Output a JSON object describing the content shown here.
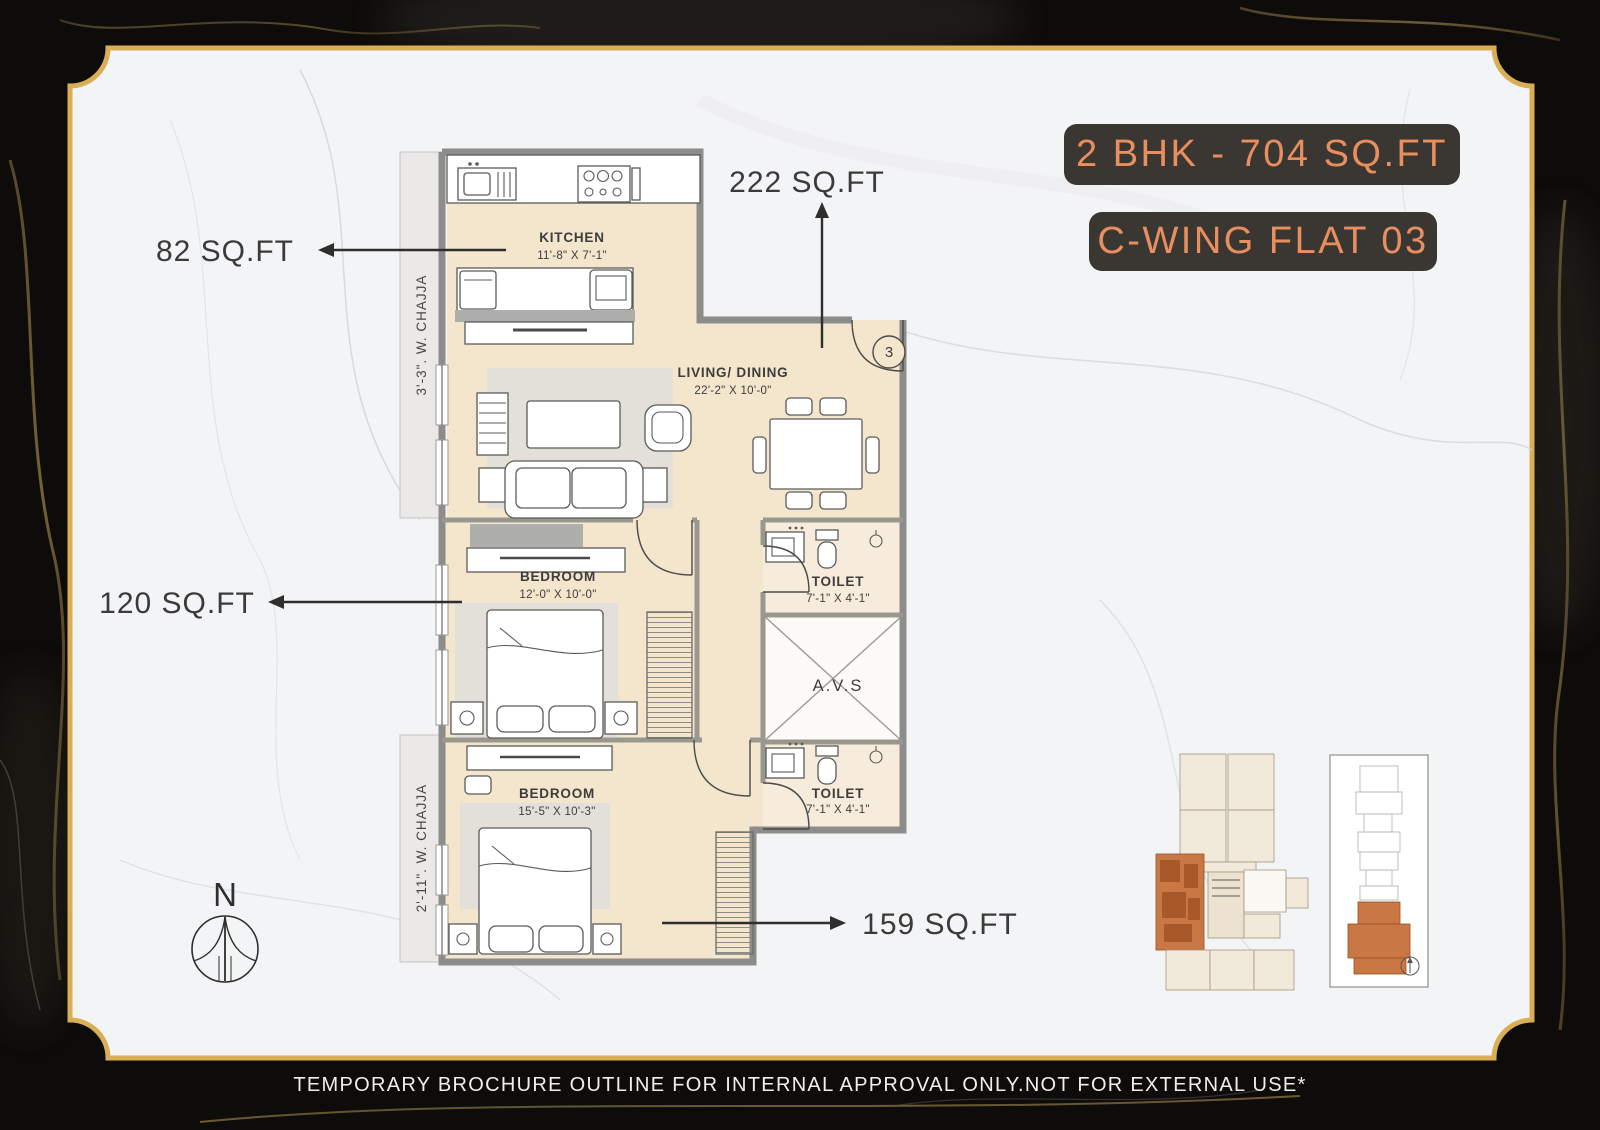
{
  "title_badges": {
    "unit_area": "2 BHK - 704 SQ.FT",
    "flat": "C-WING FLAT 03"
  },
  "area_callouts": {
    "living": "222 SQ.FT",
    "kitchen": "82 SQ.FT",
    "bedroom1": "120 SQ.FT",
    "bedroom2": "159 SQ.FT"
  },
  "rooms": {
    "kitchen": {
      "name": "KITCHEN",
      "dims": "11'-8\" X 7'-1\""
    },
    "living_dining": {
      "name": "LIVING/ DINING",
      "dims": "22'-2\" X 10'-0\""
    },
    "bedroom1": {
      "name": "BEDROOM",
      "dims": "12'-0\" X 10'-0\""
    },
    "bedroom2": {
      "name": "BEDROOM",
      "dims": "15'-5\" X 10'-3\""
    },
    "toilet1": {
      "name": "TOILET",
      "dims": "7'-1\" X 4'-1\""
    },
    "toilet2": {
      "name": "TOILET",
      "dims": "7'-1\" X 4'-1\""
    },
    "shaft": {
      "name": "A.V.S"
    }
  },
  "annotations": {
    "chajja_top": "3'-3\". W. CHAJJA",
    "chajja_bottom": "2'-11\". W. CHAJJA",
    "entry_flat_number": "3",
    "compass_north": "N"
  },
  "footer": {
    "disclaimer": "TEMPORARY BROCHURE OUTLINE FOR INTERNAL APPROVAL ONLY.NOT FOR EXTERNAL USE*"
  },
  "colors": {
    "gold_frame": "#d9ae55",
    "marble_light": "#f3f4f6",
    "marble_dark": "#0e0c0a",
    "badge_bg": "#3a3733",
    "badge_text": "#e98f5f",
    "floor": "#f4e5cd",
    "wall": "#8c8c8a",
    "highlight_unit": "#c97845"
  }
}
